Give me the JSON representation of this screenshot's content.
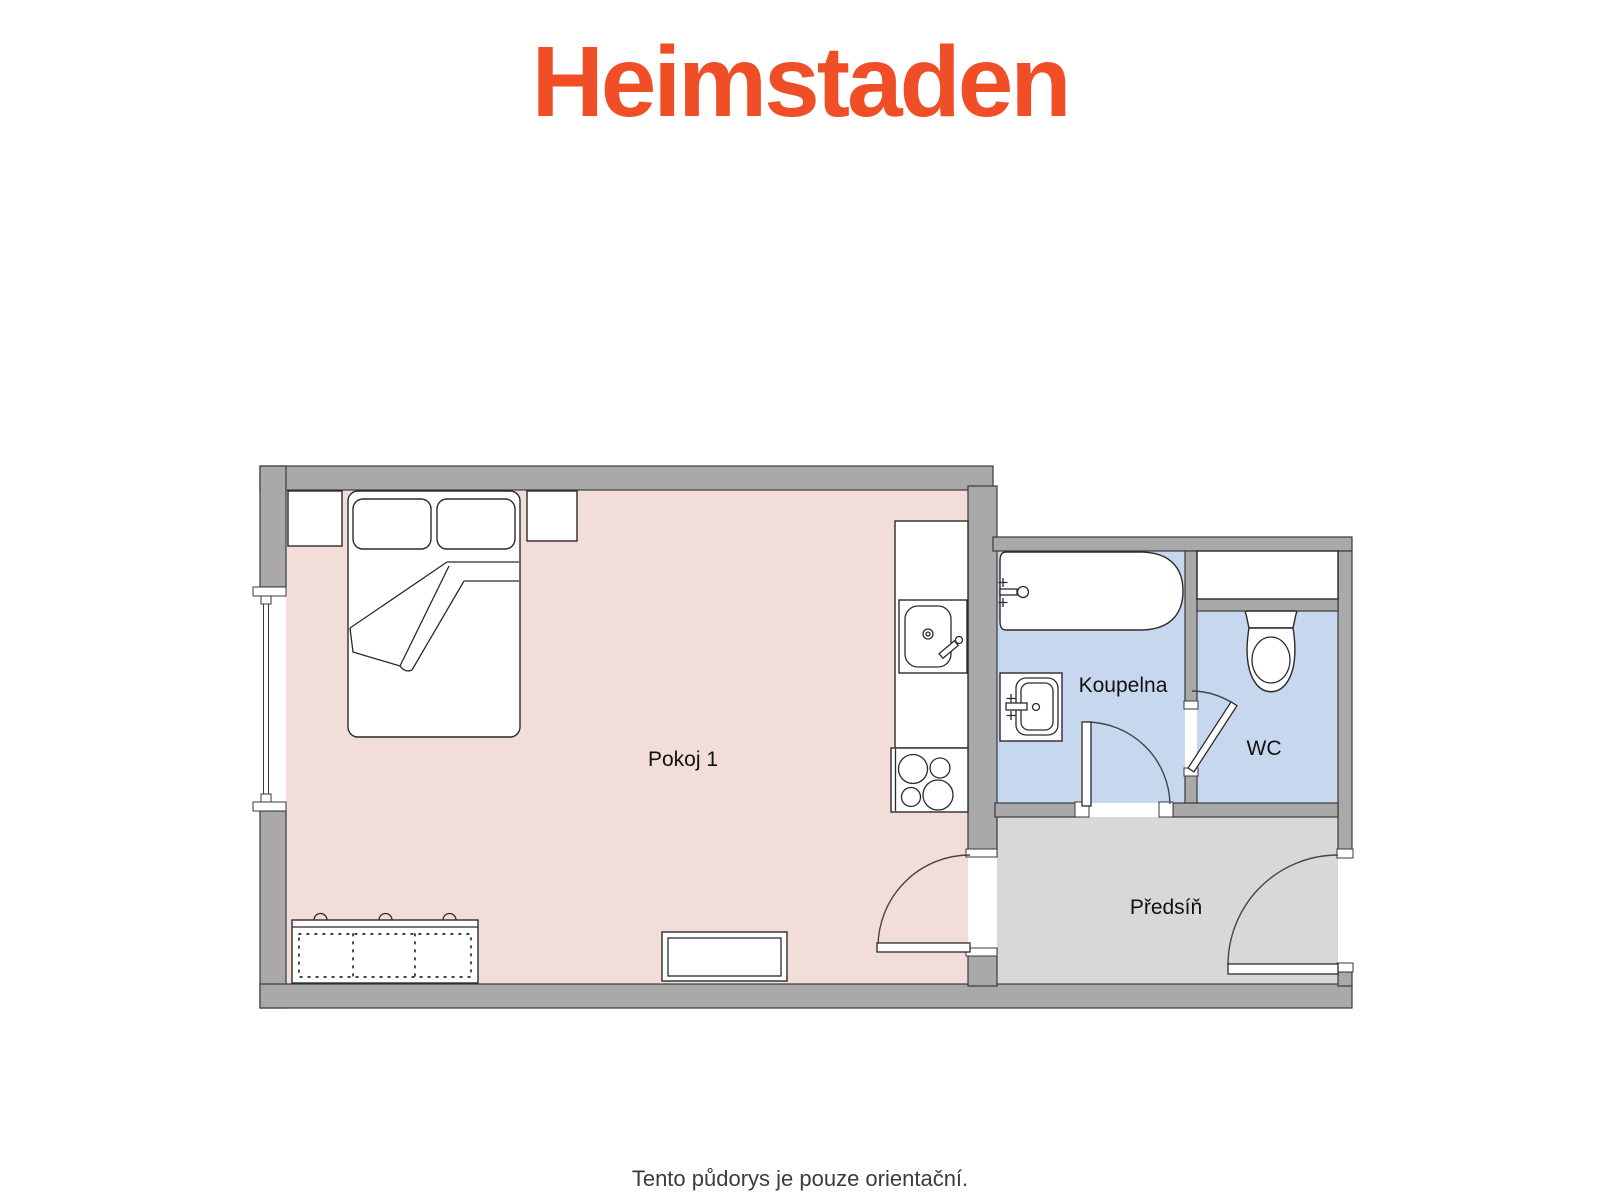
{
  "logo": {
    "text": "Heimstaden",
    "color": "#F04E27"
  },
  "plan": {
    "rooms": [
      {
        "id": "pokoj-1",
        "label": "Pokoj 1",
        "floor_color": "#f3ddd8"
      },
      {
        "id": "koupelna",
        "label": "Koupelna",
        "floor_color": "#c7d7ee"
      },
      {
        "id": "wc",
        "label": "WC",
        "floor_color": "#c7d7ee"
      },
      {
        "id": "predsin",
        "label": "Předsíň",
        "floor_color": "#d8d8d8"
      }
    ],
    "fixtures": [
      "double-bed",
      "pillow",
      "pillow",
      "nightstand",
      "nightstand",
      "wardrobe",
      "bench",
      "kitchen-counter",
      "kitchen-sink",
      "stove",
      "bathtub",
      "washbasin",
      "toilet",
      "window",
      "door",
      "door",
      "door",
      "entrance-door"
    ],
    "colors": {
      "wall_fill": "#a9a9a9",
      "wall_outline": "#3a3a3a",
      "fixture_outline": "#2b2b2b"
    }
  },
  "footer": {
    "disclaimer": "Tento půdorys je pouze orientační.",
    "color": "#3c3c3c"
  }
}
